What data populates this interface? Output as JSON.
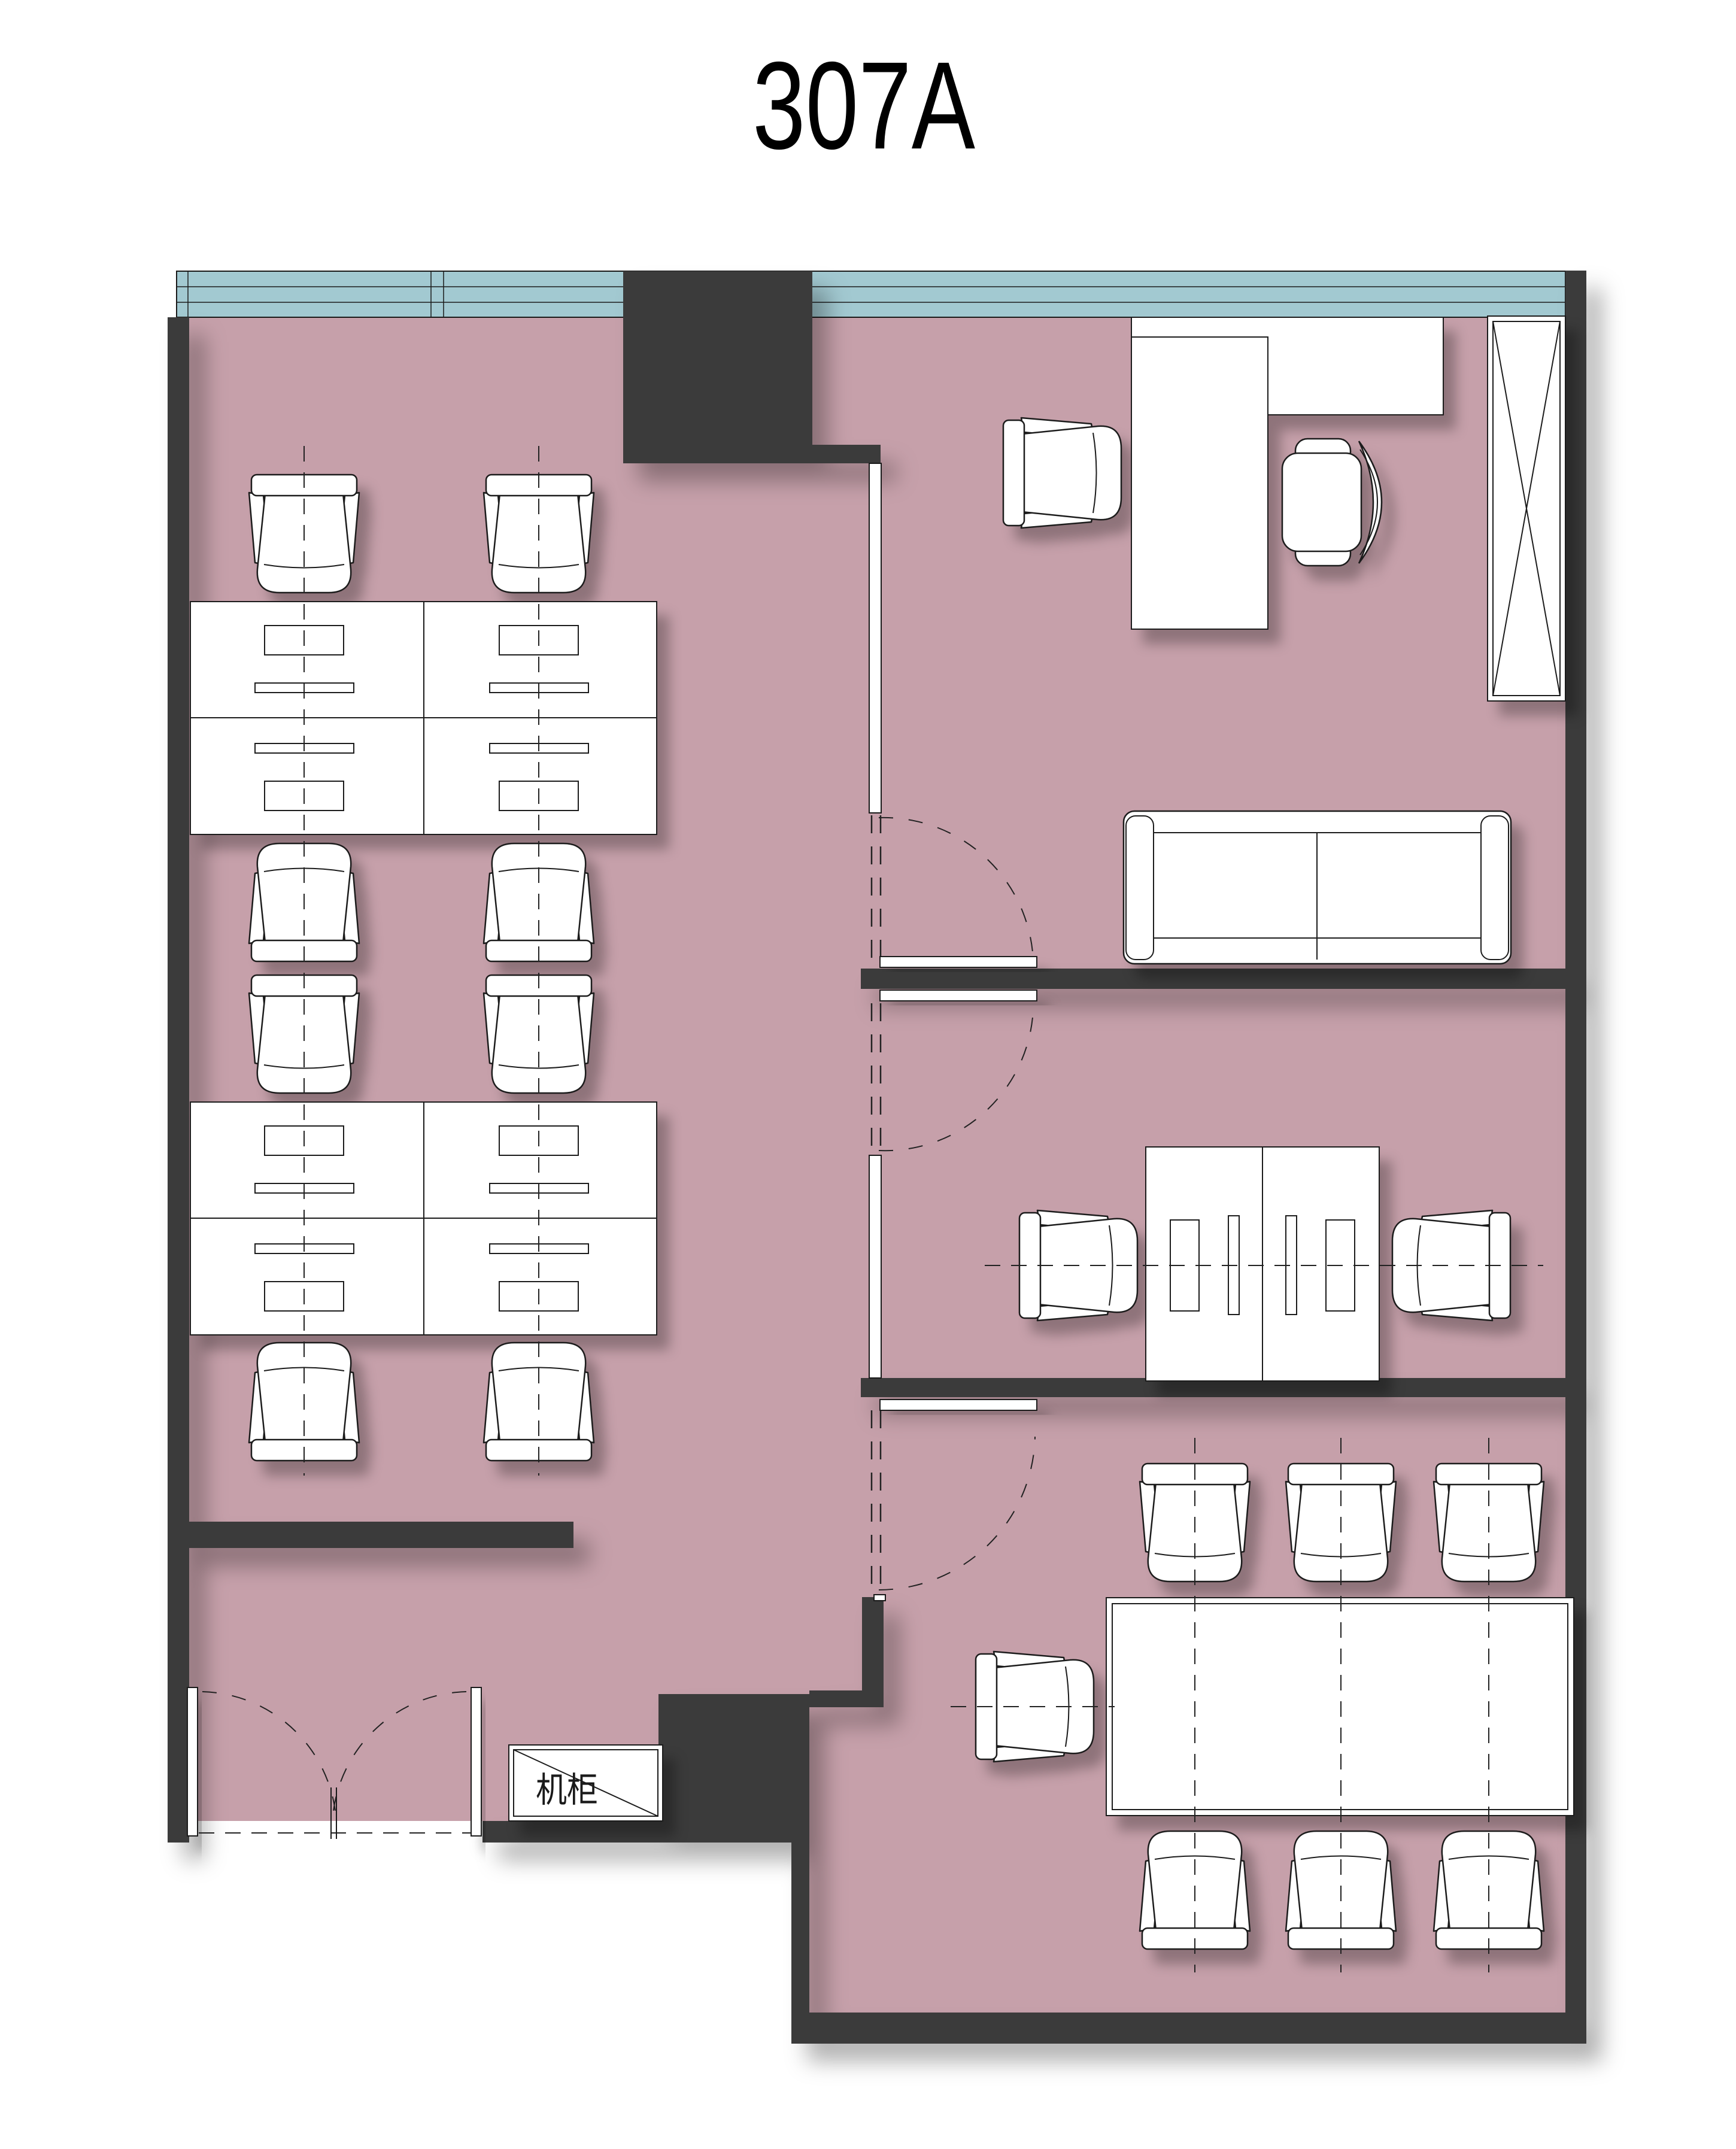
{
  "title": "307A",
  "labels": {
    "cabinet": "机柜"
  },
  "colors": {
    "floor": "#c6a0aa",
    "window": "#a2c9d1",
    "wall": "#3b3b3b",
    "furniture": "#ffffff"
  },
  "plan": {
    "drawing_type": "office floor plan",
    "unit_number": "307A",
    "zones": {
      "open_office_workstations": 8,
      "private_office": {
        "desk": 1,
        "credenza": 1,
        "executive_chair": 1,
        "visitor_chair": 1,
        "sofa": 1,
        "tall_cabinet": 1
      },
      "meeting_room": {
        "face_to_face_desks": 2,
        "chairs": 2
      },
      "conference_room": {
        "table": 1,
        "chairs": 7
      },
      "entrance": {
        "double_door": 1,
        "server_cabinet_label": "机柜"
      }
    }
  }
}
